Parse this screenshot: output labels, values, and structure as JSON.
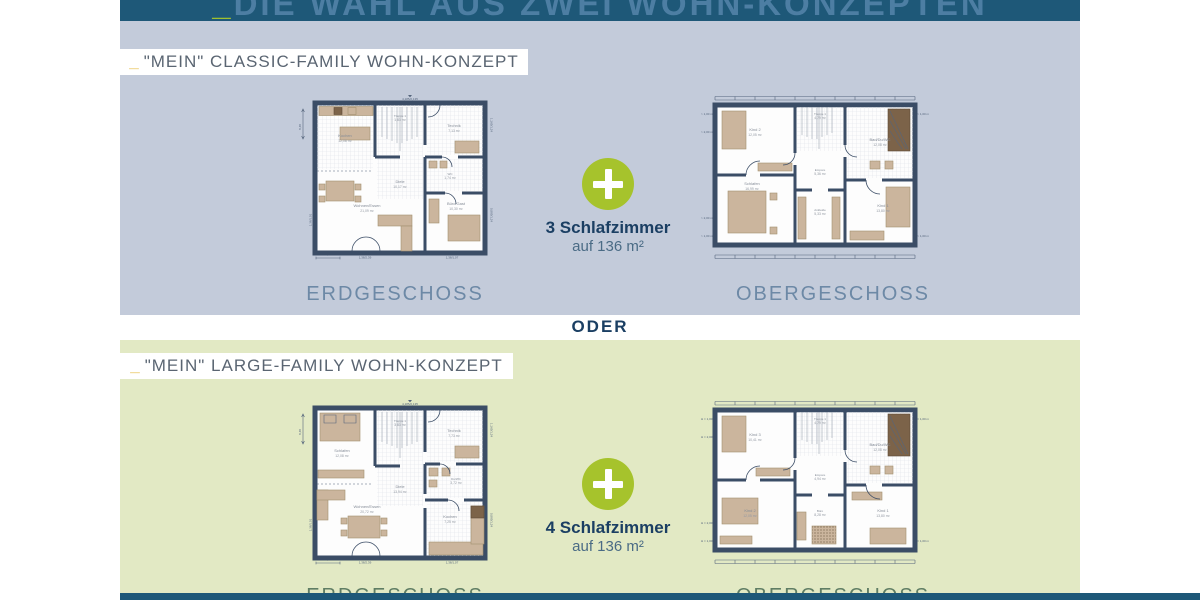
{
  "header": {
    "underscore": "_",
    "title": "DIE WAHL AUS ZWEI WOHN-KONZEPTEN"
  },
  "divider": "ODER",
  "sections": [
    {
      "tag_underscore": "_",
      "tag": "\"MEIN\" CLASSIC-FAMILY WOHN-KONZEPT",
      "bedrooms": "3 Schlafzimmer",
      "area": "auf 136 m²",
      "captions": {
        "eg": "ERDGESCHOSS",
        "og": "OBERGESCHOSS"
      }
    },
    {
      "tag_underscore": "_",
      "tag": "\"MEIN\" LARGE-FAMILY WOHN-KONZEPT",
      "bedrooms": "4 Schlafzimmer",
      "area": "auf 136 m²",
      "captions": {
        "eg": "ERDGESCHOSS",
        "og": "OBERGESCHOSS"
      }
    }
  ],
  "plans": {
    "classic_eg": {
      "rooms": [
        {
          "name": "Kochen",
          "area": "12,08 m²"
        },
        {
          "name": "Treppe 1",
          "area": "1,83 m²"
        },
        {
          "name": "Technik",
          "area": "7,13 m²"
        },
        {
          "name": "Diele",
          "area": "10,17 m²"
        },
        {
          "name": "WC",
          "area": "1,74 m²"
        },
        {
          "name": "Wohnen/Essen",
          "area": "21,09 m²"
        },
        {
          "name": "Büro/Gast",
          "area": "10,30 m²"
        }
      ],
      "dims": {
        "top": "4,185/2,135",
        "left": "8,48",
        "width": "9,58",
        "b1": "1,38/2,39",
        "b2": "1,38/1,07",
        "r1": "1,165/1,24",
        "r2": "0,885/1,24",
        "l1": "1,38/1,01"
      }
    },
    "classic_og": {
      "rooms": [
        {
          "name": "Kind 2",
          "area": "12,05 m²"
        },
        {
          "name": "Treppe 1",
          "area": "4,79 m²"
        },
        {
          "name": "Bad/Du/WC",
          "area": "12,08 m²"
        },
        {
          "name": "Empore",
          "area": "5,36 m²"
        },
        {
          "name": "Schlafen",
          "area": "16,99 m²"
        },
        {
          "name": "Ankleide",
          "area": "5,33 m²"
        },
        {
          "name": "Kind 1",
          "area": "13,80 m²"
        }
      ],
      "dims": {
        "side1": "> 1,00 m",
        "side2": "> 2,00 m"
      }
    },
    "large_eg": {
      "rooms": [
        {
          "name": "Schlafen",
          "area": "12,08 m²"
        },
        {
          "name": "Treppe 1",
          "area": "3,83 m²"
        },
        {
          "name": "Technik",
          "area": "7,73 m²"
        },
        {
          "name": "Diele",
          "area": "13,94 m²"
        },
        {
          "name": "Du/WC",
          "area": "3,72 m²"
        },
        {
          "name": "Wohnen/Essen",
          "area": "20,72 m²"
        },
        {
          "name": "Kochen",
          "area": "7,25 m²"
        }
      ],
      "dims": {
        "top": "4,185/2,135",
        "left": "8,48",
        "width": "9,58",
        "b1": "1,38/2,39",
        "b2": "1,38/1,07",
        "r1": "1,165/1,24",
        "r2": "0,885/1,24",
        "l1": "1,38/1,01"
      }
    },
    "large_og": {
      "rooms": [
        {
          "name": "Kind 3",
          "area": "10,41 m²"
        },
        {
          "name": "Treppe 1",
          "area": "4,79 m²"
        },
        {
          "name": "Bad/Du/WC",
          "area": "12,08 m²"
        },
        {
          "name": "Empore",
          "area": "4,94 m²"
        },
        {
          "name": "Kind 2",
          "area": "12,05 m²"
        },
        {
          "name": "Büro",
          "area": "8,28 m²"
        },
        {
          "name": "Kind 1",
          "area": "13,80 m²"
        }
      ],
      "dims": {
        "side1": "H = 1,00 m",
        "side2": "H = 2,00 m"
      }
    }
  },
  "colors": {
    "header_navy": "#1e5878",
    "panel_blue": "#c3cbda",
    "panel_green": "#e2e9c4",
    "plus_green": "#a6c32c",
    "navy_text": "#1b3f63",
    "accent_green": "#9fc02e",
    "accent_yellow": "#e5bb45"
  }
}
